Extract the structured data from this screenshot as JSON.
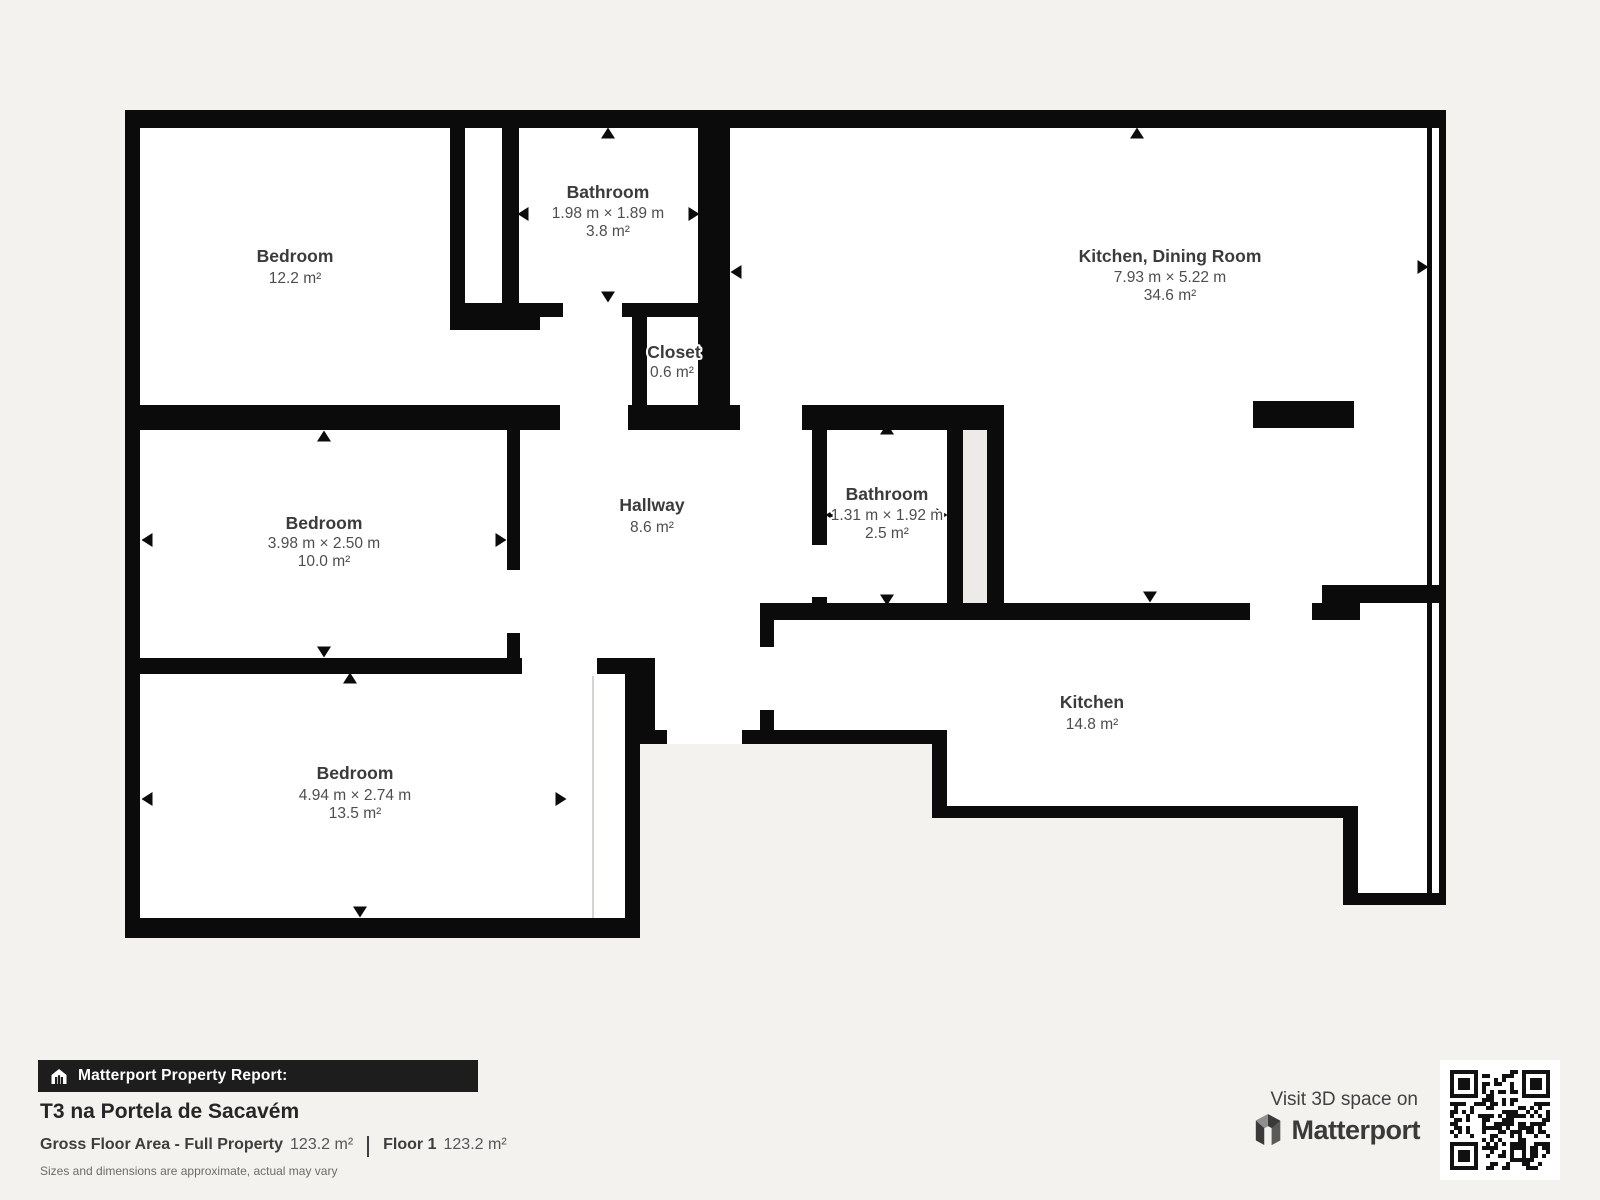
{
  "canvas": {
    "background_color": "#f3f2ef",
    "wall_color": "#0b0b0b",
    "room_fill": "#ffffff",
    "shaft_fill": "#ecebe7"
  },
  "floorplan": {
    "rooms": [
      {
        "name": "Bedroom",
        "area": "12.2 m²"
      },
      {
        "name": "Bathroom",
        "dims": "1.98 m × 1.89 m",
        "area": "3.8 m²"
      },
      {
        "name": "Kitchen, Dining Room",
        "dims": "7.93 m × 5.22 m",
        "area": "34.6 m²"
      },
      {
        "name": "Closet",
        "area": "0.6 m²"
      },
      {
        "name": "Bedroom",
        "dims": "3.98 m × 2.50 m",
        "area": "10.0 m²"
      },
      {
        "name": "Hallway",
        "area": "8.6 m²"
      },
      {
        "name": "Bathroom",
        "dims": "1.31 m × 1.92 m",
        "area": "2.5 m²"
      },
      {
        "name": "Kitchen",
        "area": "14.8 m²"
      },
      {
        "name": "Bedroom",
        "dims": "4.94 m × 2.74 m",
        "area": "13.5 m²"
      }
    ]
  },
  "report": {
    "badge": "Matterport Property Report:",
    "title": "T3 na Portela de Sacavém",
    "gfa_label": "Gross Floor Area - Full Property",
    "gfa_value": "123.2 m²",
    "floor_label": "Floor 1",
    "floor_value": "123.2 m²",
    "disclaimer": "Sizes and dimensions are approximate, actual may vary"
  },
  "promo": {
    "visit": "Visit 3D space on",
    "brand": "Matterport"
  }
}
